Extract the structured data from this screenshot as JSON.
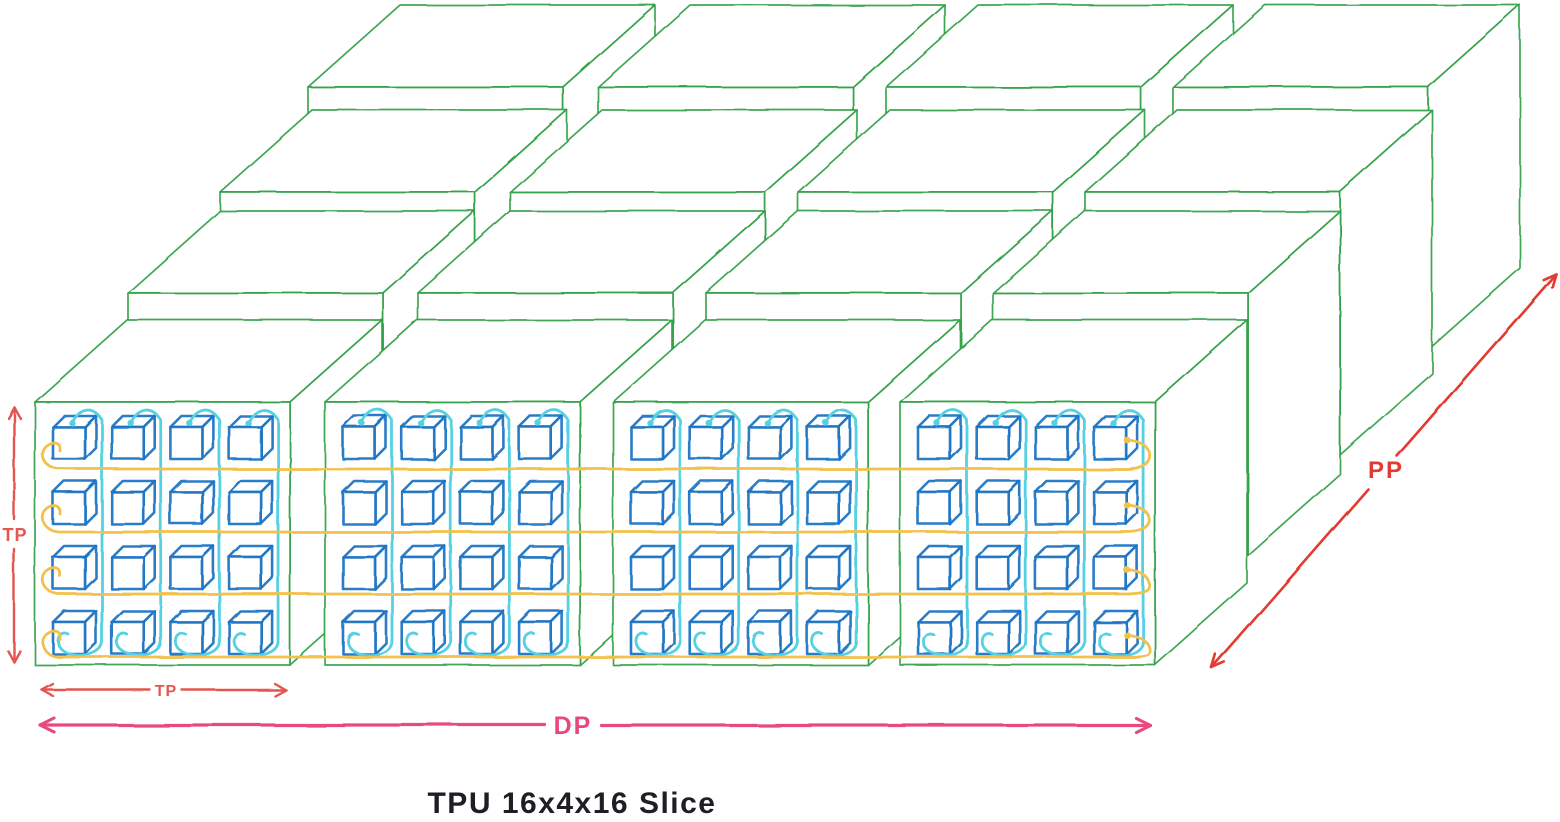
{
  "title": "TPU 16x4x16 Slice",
  "labels": {
    "tp_vertical": "TP",
    "tp_horizontal": "TP",
    "dp": "DP",
    "pp": "PP"
  },
  "colors": {
    "pod_green": "#2f9e44",
    "chip_blue": "#1971c2",
    "tp_ring_cyan": "#54d1e3",
    "dp_ring_yellow": "#f2c14b",
    "tp_arrow_red": "#e4564e",
    "dp_arrow_pink": "#e8487f",
    "pp_arrow_red": "#e23b33",
    "title_ink": "#1e1e24",
    "background": "#ffffff"
  },
  "structure": {
    "pod_rows_depth": 4,
    "pod_cols_width": 4,
    "chip_rows_per_pod": 4,
    "chip_cols_per_pod": 4,
    "tp_rings_per_pod": 4,
    "dp_rings": 4
  }
}
